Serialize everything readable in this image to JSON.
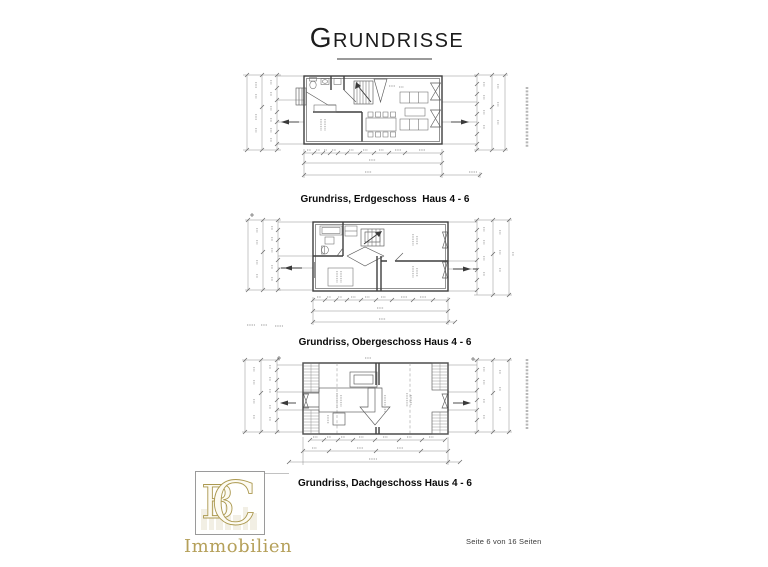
{
  "page": {
    "title": "Grundrisse",
    "footer": "Seite 6 von 16 Seiten"
  },
  "figures": [
    {
      "caption": "Grundriss, Erdgeschoss  Haus 4 - 6"
    },
    {
      "caption": "Grundriss, Obergeschoss Haus 4 - 6"
    },
    {
      "caption": "Grundriss, Dachgeschoss Haus 4 - 6"
    }
  ],
  "logo": {
    "monogram": [
      "B",
      "C"
    ],
    "name": "Immobilien"
  },
  "colors": {
    "gold": "#b5a05a",
    "ink": "#3f3f3f",
    "dim": "#8f8f8f"
  }
}
